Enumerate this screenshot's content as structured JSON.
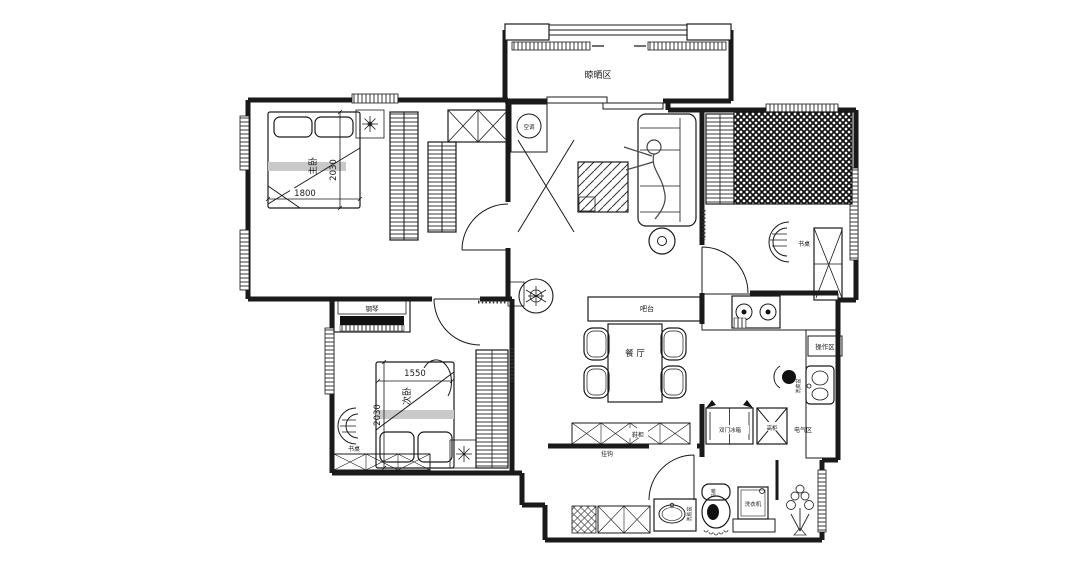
{
  "colors": {
    "line": "#1a1a1a",
    "background": "#ffffff",
    "runner_gray": "#c9c9c9",
    "fill_dark": "#111111"
  },
  "rooms": {
    "drying_area": "晾晒区",
    "master_bedroom": "主卧",
    "second_bedroom": "次卧",
    "dining_room": "餐 厅"
  },
  "dimensions": {
    "master_width": "1800",
    "master_depth": "2030",
    "second_width": "1550",
    "second_depth": "2030"
  },
  "fixtures": {
    "air_conditioner": "空调",
    "piano": "钢琴",
    "desk_second_bedroom": "书桌",
    "desk_study": "书桌",
    "bar_counter": "吧台",
    "work_area": "操作区",
    "kitchen_sink": "洗菜盆",
    "fridge": "双门冰箱",
    "tall_cabinet": "高柜",
    "electrical_area": "电气区",
    "shoe_cabinet": "鞋柜",
    "hooks": "挂钩",
    "wash_basin": "洗脸盆",
    "toilet": "马桶",
    "washing_machine": "洗衣机"
  }
}
